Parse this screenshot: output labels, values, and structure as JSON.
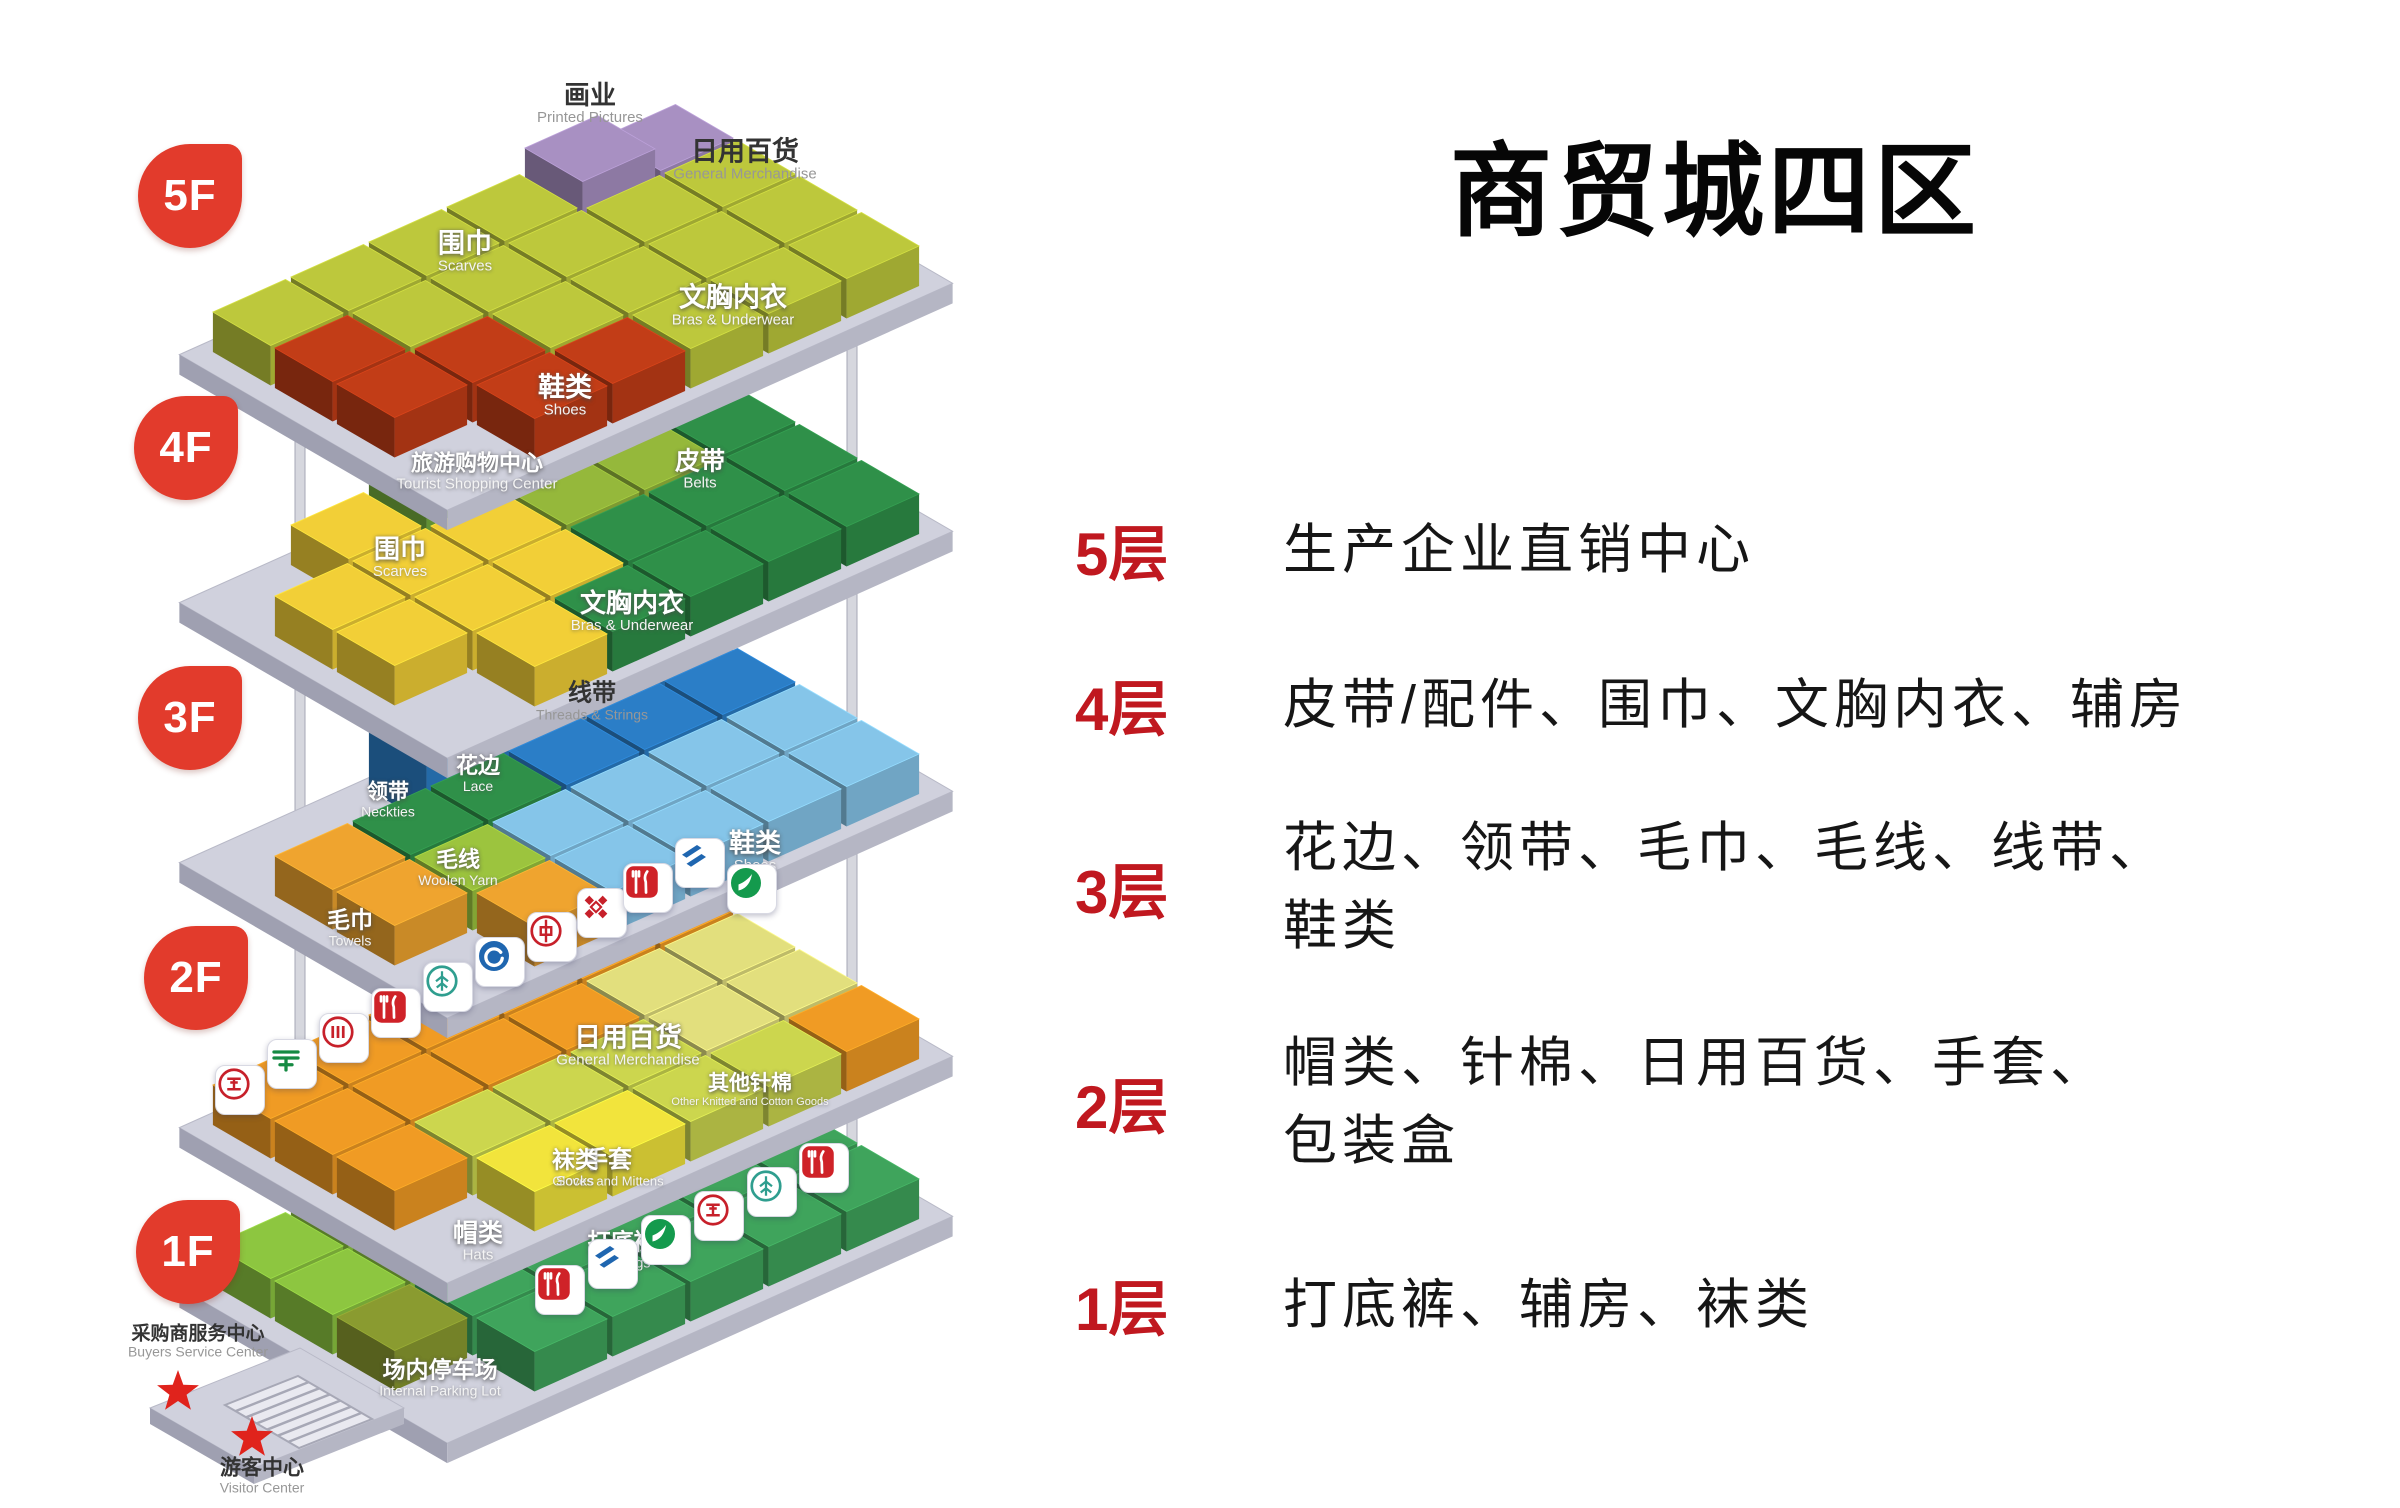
{
  "title": "商贸城四区",
  "legend": {
    "accent_color": "#c0181f",
    "text_color": "#161616",
    "rows": [
      {
        "floor": "5层",
        "lines": [
          "生产企业直销中心"
        ]
      },
      {
        "floor": "4层",
        "lines": [
          "皮带/配件、围巾、文胸内衣、辅房"
        ]
      },
      {
        "floor": "3层",
        "lines": [
          "花边、领带、毛巾、毛线、线带、",
          "鞋类"
        ]
      },
      {
        "floor": "2层",
        "lines": [
          "帽类、针棉、日用百货、手套、",
          "包装盒"
        ]
      },
      {
        "floor": "1层",
        "lines": [
          "打底裤、辅房、袜类"
        ]
      }
    ]
  },
  "diagram": {
    "geometry": {
      "col": [
        78,
        -35
      ],
      "row": [
        62,
        36
      ],
      "h": 40,
      "tall": 24,
      "plat": 20,
      "platform_top": "#d0d1dd",
      "platform_left": "#9fa0b1",
      "platform_right": "#b5b6c4",
      "badge_color": "#e23b2c"
    },
    "poles": [
      {
        "x": 300,
        "y1": 430,
        "y2": 1400
      },
      {
        "x": 852,
        "y1": 305,
        "y2": 1243
      }
    ],
    "stars": [
      {
        "x": 178,
        "y": 1392
      },
      {
        "x": 252,
        "y": 1438
      }
    ],
    "floors": [
      {
        "id": "5F",
        "badge": "5F",
        "badge_x": 190,
        "badge_y": 196,
        "origin": [
          208,
          352
        ],
        "palette": {
          "Y": "#bdc83c",
          "R": "#c23d17",
          "P": "#a890c2"
        },
        "grid": [
          "YYYYPP",
          "RYYYYY",
          "RRYYYY",
          ".RRYYY"
        ],
        "tall": [
          [
            0,
            4
          ]
        ],
        "labels": [
          {
            "name": "printed-pictures",
            "zh": "画业",
            "en": "Printed Pictures",
            "x": 590,
            "y": 104,
            "dark": true,
            "zs": 26,
            "es": 15
          },
          {
            "name": "general-merchandise-5f",
            "zh": "日用百货",
            "en": "General Merchandise",
            "x": 745,
            "y": 160,
            "dark": true,
            "zs": 27,
            "es": 15
          },
          {
            "name": "scarves-5f",
            "zh": "围巾",
            "en": "Scarves",
            "x": 465,
            "y": 252,
            "zs": 27,
            "es": 15
          },
          {
            "name": "bras-underwear-5f",
            "zh": "文胸内衣",
            "en": "Bras & Underwear",
            "x": 733,
            "y": 306,
            "zs": 27,
            "es": 15
          },
          {
            "name": "shoes-5f",
            "zh": "鞋类",
            "en": "Shoes",
            "x": 565,
            "y": 396,
            "zs": 27,
            "es": 15
          },
          {
            "name": "tourist-shopping-center",
            "zh": "旅游购物中心",
            "en": "Tourist Shopping Center",
            "x": 477,
            "y": 472,
            "zs": 22,
            "es": 15
          }
        ]
      },
      {
        "id": "4F",
        "badge": "4F",
        "badge_x": 186,
        "badge_y": 448,
        "origin": [
          208,
          600
        ],
        "palette": {
          "Y": "#f2cf37",
          "B": "#95b83b",
          "T": "#74ad3e",
          "G": "#2f9049"
        },
        "grid": [
          ".YTBBB",
          "YYYBBG",
          "YYYGGG",
          ".YGGGG"
        ],
        "tall": [
          [
            0,
            2
          ]
        ],
        "labels": [
          {
            "name": "belts",
            "zh": "皮带",
            "en": "Belts",
            "x": 700,
            "y": 470,
            "zs": 25,
            "es": 15
          },
          {
            "name": "scarves-4f",
            "zh": "围巾",
            "en": "Scarves",
            "x": 400,
            "y": 558,
            "zs": 26,
            "es": 15
          },
          {
            "name": "bras-underwear-4f",
            "zh": "文胸内衣",
            "en": "Bras & Underwear",
            "x": 632,
            "y": 612,
            "zs": 26,
            "es": 15
          }
        ]
      },
      {
        "id": "3F",
        "badge": "3F",
        "badge_x": 190,
        "badge_y": 718,
        "origin": [
          208,
          860
        ],
        "palette": {
          "O": "#efa42f",
          "N": "#2f9049",
          "W": "#9cc43e",
          "D": "#2b7ec7",
          "L": "#85c5e9"
        },
        "grid": [
          "..DDDD",
          "ONNDDD",
          "OWLLLL",
          ".OLLLL"
        ],
        "tall": [
          [
            0,
            2
          ],
          [
            0,
            3
          ]
        ],
        "labels": [
          {
            "name": "threads-strings",
            "zh": "线带",
            "en": "Threads & Strings",
            "x": 592,
            "y": 702,
            "dark": true,
            "zs": 24,
            "es": 14
          },
          {
            "name": "neckties",
            "zh": "领带",
            "en": "Neckties",
            "x": 388,
            "y": 800,
            "zs": 21,
            "es": 14
          },
          {
            "name": "lace",
            "zh": "花边",
            "en": "Lace",
            "x": 478,
            "y": 774,
            "zs": 22,
            "es": 14
          },
          {
            "name": "woolen-yarn",
            "zh": "毛线",
            "en": "Woolen Yarn",
            "x": 458,
            "y": 868,
            "zs": 22,
            "es": 14
          },
          {
            "name": "towels",
            "zh": "毛巾",
            "en": "Towels",
            "x": 350,
            "y": 928,
            "zs": 23,
            "es": 14
          },
          {
            "name": "shoes-3f",
            "zh": "鞋类",
            "en": "Shoes",
            "x": 755,
            "y": 852,
            "zs": 26,
            "es": 15
          }
        ]
      },
      {
        "id": "2F",
        "badge": "2F",
        "badge_x": 196,
        "badge_y": 978,
        "origin": [
          208,
          1125
        ],
        "palette": {
          "O": "#f09b24",
          "P": "#e2df7d",
          "G": "#ccd64e",
          "H": "#f2e43c"
        },
        "grid": [
          "OOOOOO",
          "OOOOPP",
          "OGGGPP",
          ".HHGGO"
        ],
        "tall": [],
        "labels": [
          {
            "name": "general-merchandise-2f",
            "zh": "日用百货",
            "en": "General Merchandise",
            "x": 628,
            "y": 1046,
            "zs": 27,
            "es": 15
          },
          {
            "name": "other-knitted-cotton",
            "zh": "其他针棉",
            "en": "Other Knitted and Cotton Goods",
            "x": 750,
            "y": 1090,
            "zs": 21,
            "es": 11
          },
          {
            "name": "gloves-mittens",
            "zh": "手套",
            "en": "Gloves and Mittens",
            "x": 608,
            "y": 1168,
            "zs": 24,
            "es": 13
          },
          {
            "name": "hats",
            "zh": "帽类",
            "en": "Hats",
            "x": 478,
            "y": 1242,
            "zs": 25,
            "es": 15
          }
        ]
      },
      {
        "id": "1F",
        "badge": "1F",
        "badge_x": 188,
        "badge_y": 1252,
        "origin": [
          208,
          1285
        ],
        "palette": {
          "S": "#8dc640",
          "V": "#8a9b30",
          "M": "#3fa45c"
        },
        "grid": [
          "SSSSSS",
          "SSSSVM",
          "VMMMMM",
          ".MMMMM"
        ],
        "tall": [],
        "labels": [
          {
            "name": "socks",
            "zh": "袜类",
            "en": "Socks",
            "x": 575,
            "y": 1168,
            "zs": 23,
            "es": 14
          },
          {
            "name": "leggings",
            "zh": "打底裤",
            "en": "Leggings",
            "x": 622,
            "y": 1250,
            "zs": 23,
            "es": 14
          },
          {
            "name": "internal-parking-lot",
            "zh": "场内停车场",
            "en": "Internal Parking Lot",
            "x": 440,
            "y": 1378,
            "zs": 23,
            "es": 14
          },
          {
            "name": "buyers-service-center",
            "zh": "采购商服务中心",
            "en": "Buyers Service Center",
            "x": 198,
            "y": 1342,
            "dark": true,
            "zs": 19,
            "es": 14
          },
          {
            "name": "visitor-center",
            "zh": "游客中心",
            "en": "Visitor Center",
            "x": 262,
            "y": 1476,
            "dark": true,
            "zs": 21,
            "es": 14
          }
        ]
      }
    ],
    "icons": [
      {
        "type": "icbc",
        "name": "icbc-bank-icon",
        "x": 240,
        "y": 1090
      },
      {
        "type": "post",
        "name": "china-post-icon",
        "x": 292,
        "y": 1064
      },
      {
        "type": "bars",
        "name": "bank-bars-icon",
        "x": 344,
        "y": 1038
      },
      {
        "type": "rest",
        "name": "restaurant-icon",
        "x": 396,
        "y": 1013
      },
      {
        "type": "abc",
        "name": "abc-bank-icon",
        "x": 448,
        "y": 987
      },
      {
        "type": "swirlb",
        "name": "blue-swirl-bank-icon",
        "x": 500,
        "y": 962
      },
      {
        "type": "boc",
        "name": "bank-of-china-icon",
        "x": 552,
        "y": 937
      },
      {
        "type": "knot",
        "name": "unionpay-knot-icon",
        "x": 602,
        "y": 913
      },
      {
        "type": "rest",
        "name": "restaurant-icon",
        "x": 648,
        "y": 888
      },
      {
        "type": "ccb",
        "name": "ccb-bank-icon",
        "x": 700,
        "y": 863
      },
      {
        "type": "swirlg",
        "name": "green-swirl-bank-icon",
        "x": 752,
        "y": 889
      },
      {
        "type": "rest",
        "name": "restaurant-icon",
        "x": 560,
        "y": 1290
      },
      {
        "type": "ccb",
        "name": "ccb-bank-icon",
        "x": 613,
        "y": 1264
      },
      {
        "type": "swirlg",
        "name": "green-swirl-bank-icon",
        "x": 666,
        "y": 1240
      },
      {
        "type": "icbc",
        "name": "icbc-bank-icon",
        "x": 719,
        "y": 1216
      },
      {
        "type": "abc",
        "name": "abc-bank-icon",
        "x": 772,
        "y": 1192
      },
      {
        "type": "rest",
        "name": "restaurant-icon",
        "x": 824,
        "y": 1168
      }
    ]
  }
}
